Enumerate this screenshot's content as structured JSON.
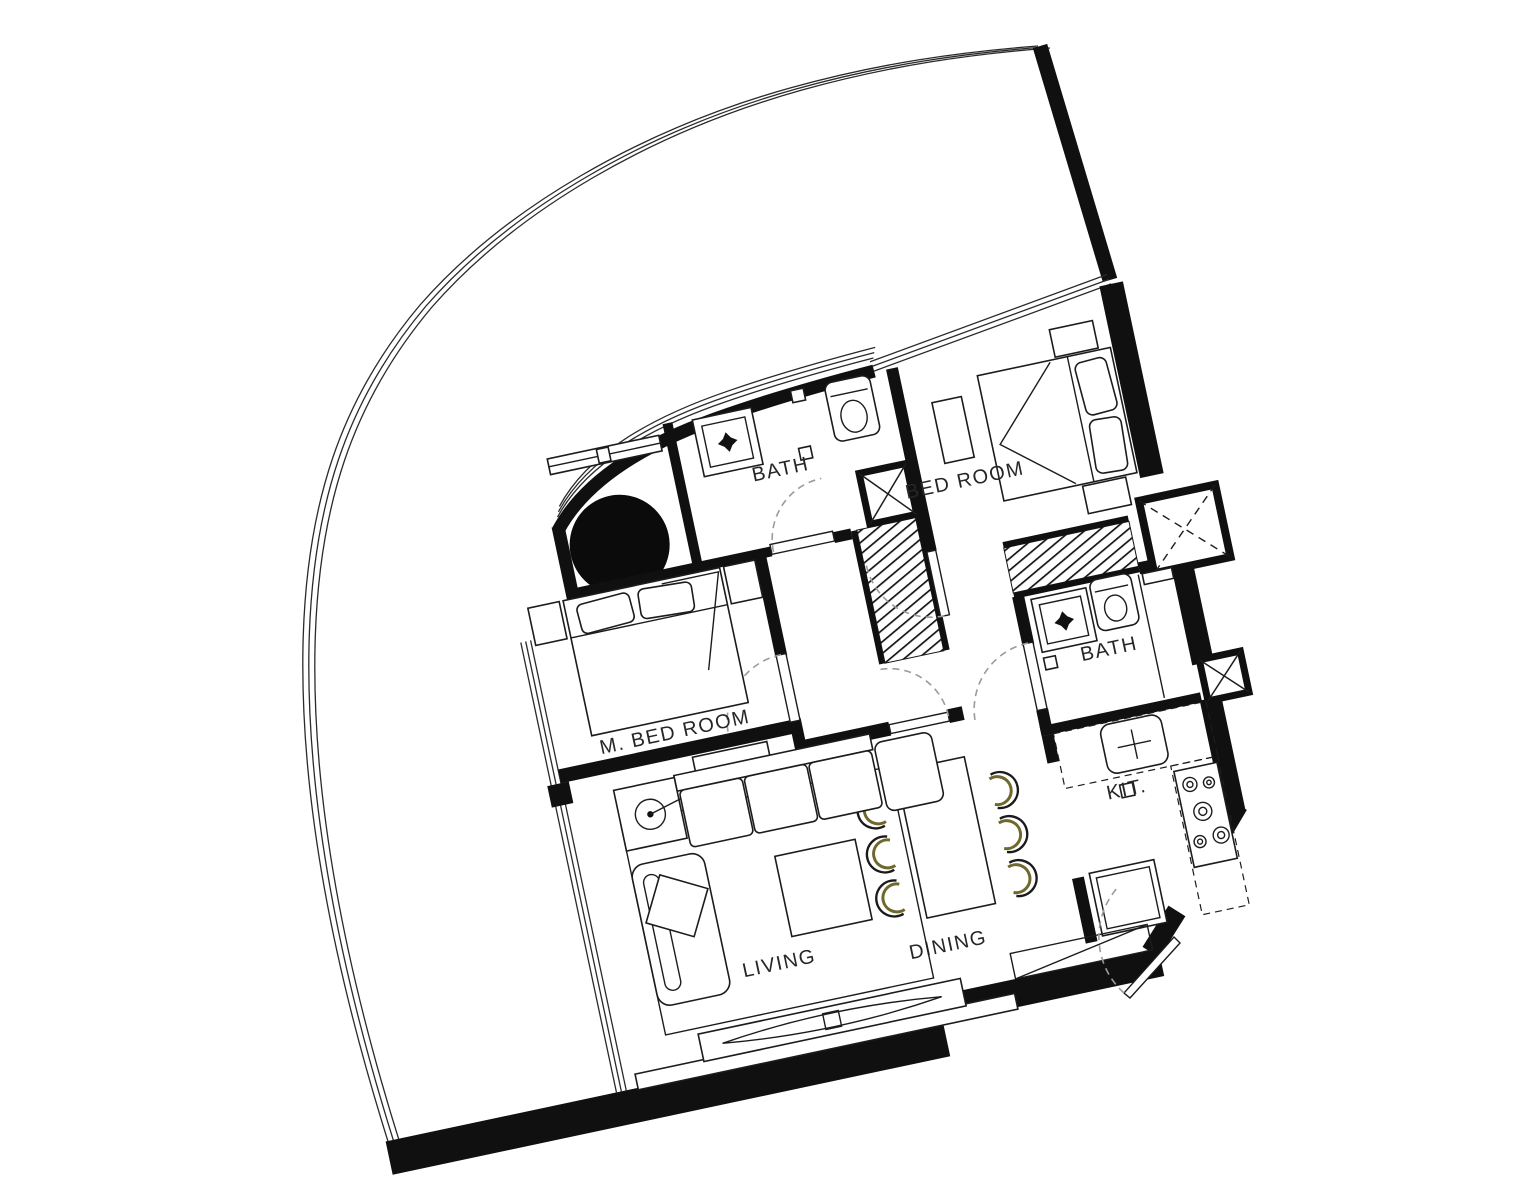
{
  "title": "2 Bedroom Apartment Floor Plan",
  "rooms": {
    "bath1": "BATH",
    "bedroom": "BED ROOM",
    "master_bedroom": "M. BED ROOM",
    "bath2": "BATH",
    "kitchen": "KIT.",
    "dining": "DINING",
    "living": "LIVING"
  },
  "colors": {
    "bg": "#ffffff",
    "wall": "#101010",
    "line": "#1c1c1c",
    "label": "#262626",
    "accent": "#6e682c",
    "arc": "#9b9b9b"
  }
}
